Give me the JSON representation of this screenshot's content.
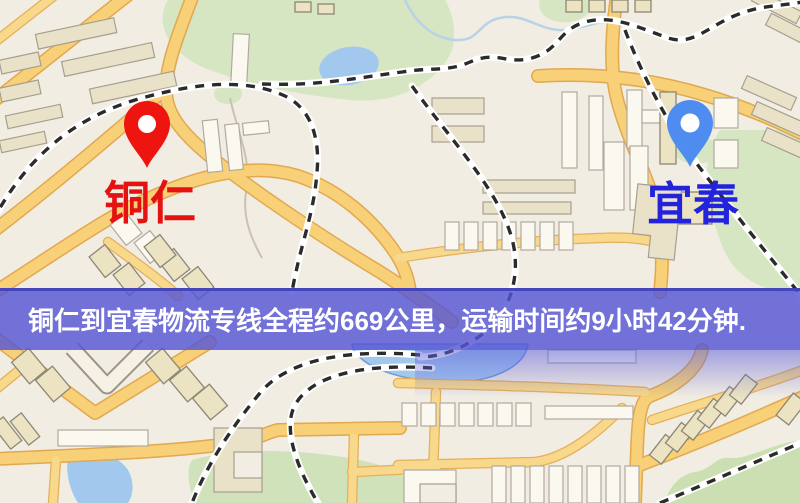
{
  "map": {
    "origin": {
      "name": "铜仁",
      "pin_icon": "map-pin-icon",
      "pin_color": "#ee1410",
      "label_color": "#e51212"
    },
    "destination": {
      "name": "宜春",
      "pin_icon": "map-pin-icon",
      "pin_color": "#4f8cf0",
      "label_color": "#2323dc"
    }
  },
  "banner": {
    "text": "铜仁到宜春物流专线全程约669公里，运输时间约9小时42分钟.",
    "bg_color": "rgba(86,86,213,0.82)",
    "text_color": "#ffffff"
  },
  "colors": {
    "map_background": "#f2ede3",
    "road": "#f7d077",
    "road_casing": "#e2a850",
    "park": "#d6e6c2",
    "water": "#a2c8ee",
    "railway_dash": "#2b2b2b",
    "building": "#e9e1c8"
  }
}
